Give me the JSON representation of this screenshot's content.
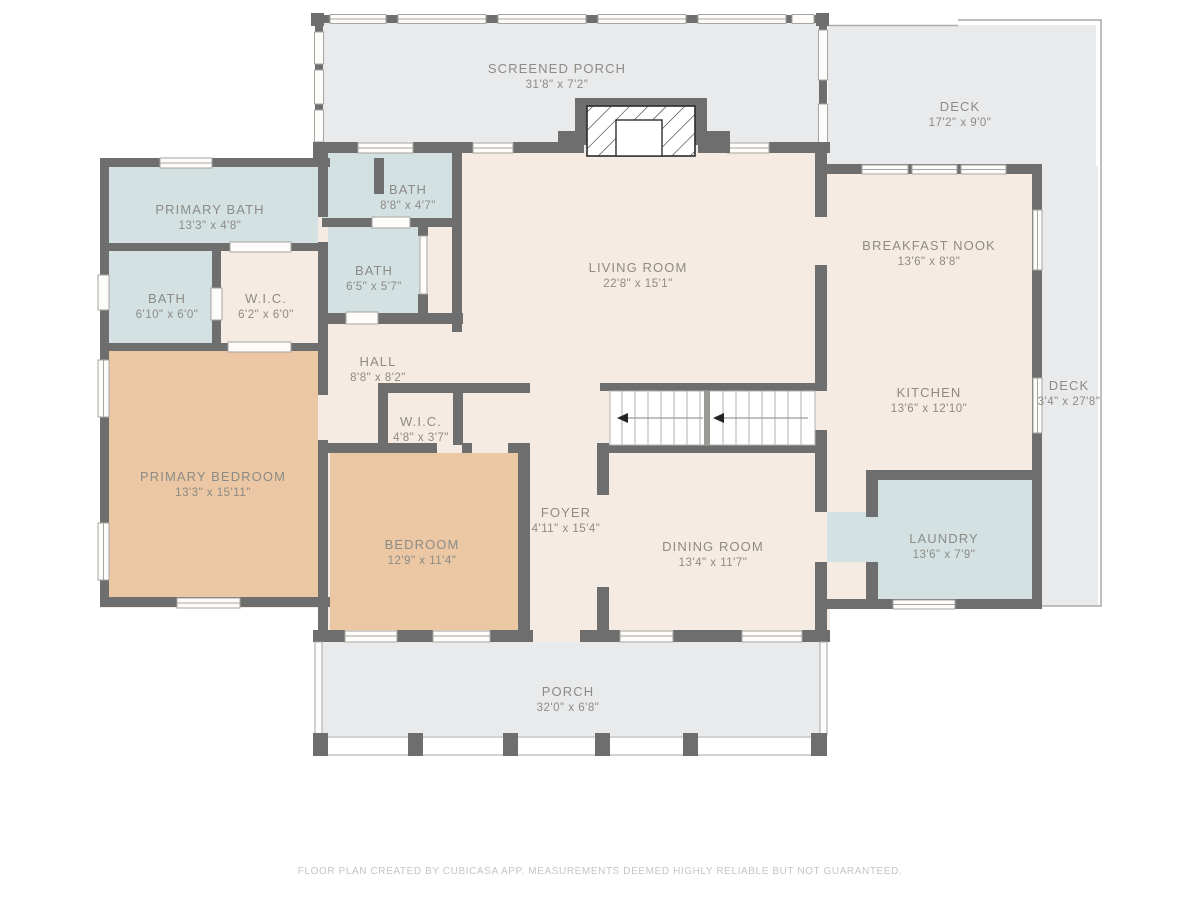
{
  "footer": "FLOOR PLAN CREATED BY CUBICASA APP. MEASUREMENTS DEEMED HIGHLY RELIABLE BUT NOT GUARANTEED.",
  "colors": {
    "wall": "#6e6e6e",
    "room_cream": "#f6ebe2",
    "wet_room_blue": "#d4e1e2",
    "bedroom_tan": "#ebc7a3",
    "outdoor_gray": "#e9eaeb",
    "stairs_white": "#ffffff",
    "label_text": "#8c8b85",
    "footer_text": "#c6c5c2"
  },
  "rooms": [
    {
      "name": "SCREENED PORCH",
      "dims": "31'8\" x 7'2\""
    },
    {
      "name": "DECK",
      "dims": "17'2\" x 9'0\""
    },
    {
      "name": "PRIMARY BATH",
      "dims": "13'3\" x 4'8\""
    },
    {
      "name": "BATH",
      "dims": "8'8\" x 4'7\""
    },
    {
      "name": "BATH",
      "dims": "6'5\" x 5'7\""
    },
    {
      "name": "BATH",
      "dims": "6'10\" x 6'0\""
    },
    {
      "name": "W.I.C.",
      "dims": "6'2\" x 6'0\""
    },
    {
      "name": "LIVING ROOM",
      "dims": "22'8\" x 15'1\""
    },
    {
      "name": "BREAKFAST NOOK",
      "dims": "13'6\" x 8'8\""
    },
    {
      "name": "KITCHEN",
      "dims": "13'6\" x 12'10\""
    },
    {
      "name": "DECK",
      "dims": "3'4\" x 27'8\""
    },
    {
      "name": "HALL",
      "dims": "8'8\" x 8'2\""
    },
    {
      "name": "W.I.C.",
      "dims": "4'8\" x 3'7\""
    },
    {
      "name": "PRIMARY BEDROOM",
      "dims": "13'3\" x 15'11\""
    },
    {
      "name": "BEDROOM",
      "dims": "12'9\" x 11'4\""
    },
    {
      "name": "FOYER",
      "dims": "4'11\" x 15'4\""
    },
    {
      "name": "DINING ROOM",
      "dims": "13'4\" x 11'7\""
    },
    {
      "name": "LAUNDRY",
      "dims": "13'6\" x 7'9\""
    },
    {
      "name": "PORCH",
      "dims": "32'0\" x 6'8\""
    }
  ]
}
